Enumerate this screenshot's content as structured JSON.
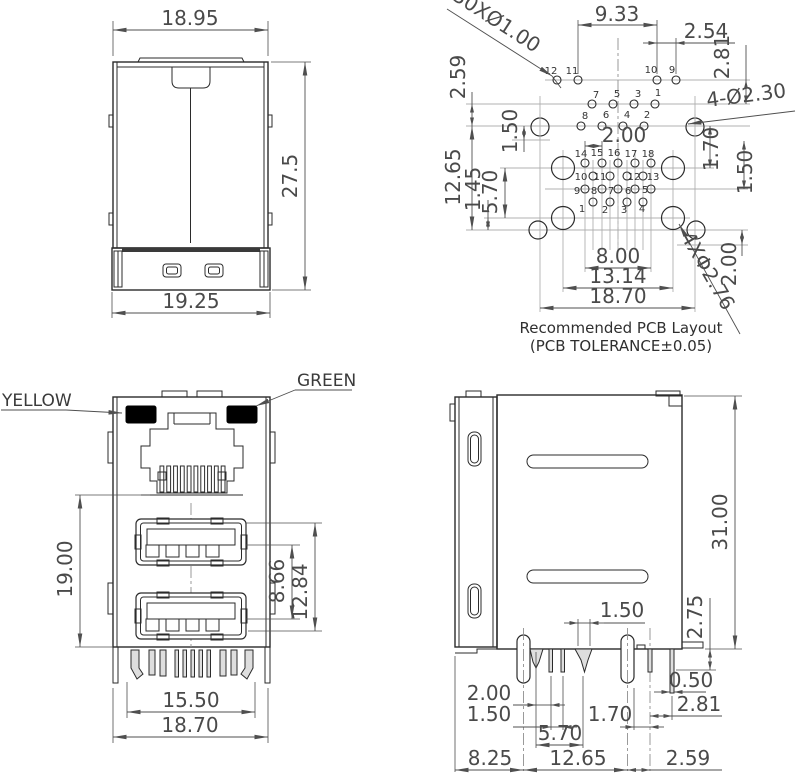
{
  "drawing_type": "connector-technical-drawing",
  "colors": {
    "background": "#ffffff",
    "line": "#2b2b2b",
    "dim_line": "#4f4f4f",
    "dim_text": "#4a4a4a",
    "centerline": "#b0b0b0",
    "led_fill": "#000000",
    "pin_fill": "#dedede"
  },
  "shield_front": {
    "dim_width_top": "18.95",
    "dim_height": "27.5",
    "dim_width_base": "19.25"
  },
  "pcb_layout": {
    "caption": "Recommended PCB Layout",
    "tolerance": "(PCB TOLERANCE±0.05)",
    "label_holes_small": "30XØ1.00",
    "label_holes_medium": "4-Ø2.30",
    "label_holes_large": "4XΦ2.76",
    "dim_9_33": "9.33",
    "dim_2_54": "2.54",
    "dim_2_81": "2.81",
    "dim_2_59": "2.59",
    "dim_12_65": "12.65",
    "dim_1_45": "1.45",
    "dim_5_70": "5.70",
    "dim_1_50_left": "1.50",
    "dim_2_00_top": "2.00",
    "dim_1_70": "1.70",
    "dim_1_50_right": "1.50",
    "dim_2_00_right": "2.00",
    "dim_8_00": "8.00",
    "dim_13_14": "13.14",
    "dim_18_70": "18.70",
    "pins_top_row": [
      "12",
      "11",
      "10",
      "9"
    ],
    "pins_mid_row": [
      "7",
      "5",
      "3",
      "1"
    ],
    "pins_low_row": [
      "8",
      "6",
      "4",
      "2"
    ],
    "cluster_row_a": [
      "14",
      "15",
      "16",
      "17",
      "18"
    ],
    "cluster_row_b": [
      "10",
      "11",
      "12",
      "13"
    ],
    "cluster_row_c": [
      "9",
      "8",
      "7",
      "6",
      "5"
    ],
    "cluster_row_d": [
      "1",
      "2",
      "3",
      "4"
    ]
  },
  "connector_front": {
    "led_left_label": "YELLOW",
    "led_right_label": "GREEN",
    "dim_height": "19.00",
    "dim_usb_pitch": "8.66",
    "dim_usb_span": "12.84",
    "dim_pins_width": "15.50",
    "dim_body_width": "18.70"
  },
  "connector_side": {
    "dim_height": "31.00",
    "dim_2_75": "2.75",
    "dim_0_50": "0.50",
    "dim_2_81": "2.81",
    "dim_1_50_pin": "1.50",
    "dim_2_00": "2.00",
    "dim_1_50": "1.50",
    "dim_1_70": "1.70",
    "dim_5_70": "5.70",
    "dim_8_25": "8.25",
    "dim_12_65": "12.65",
    "dim_2_59": "2.59"
  }
}
